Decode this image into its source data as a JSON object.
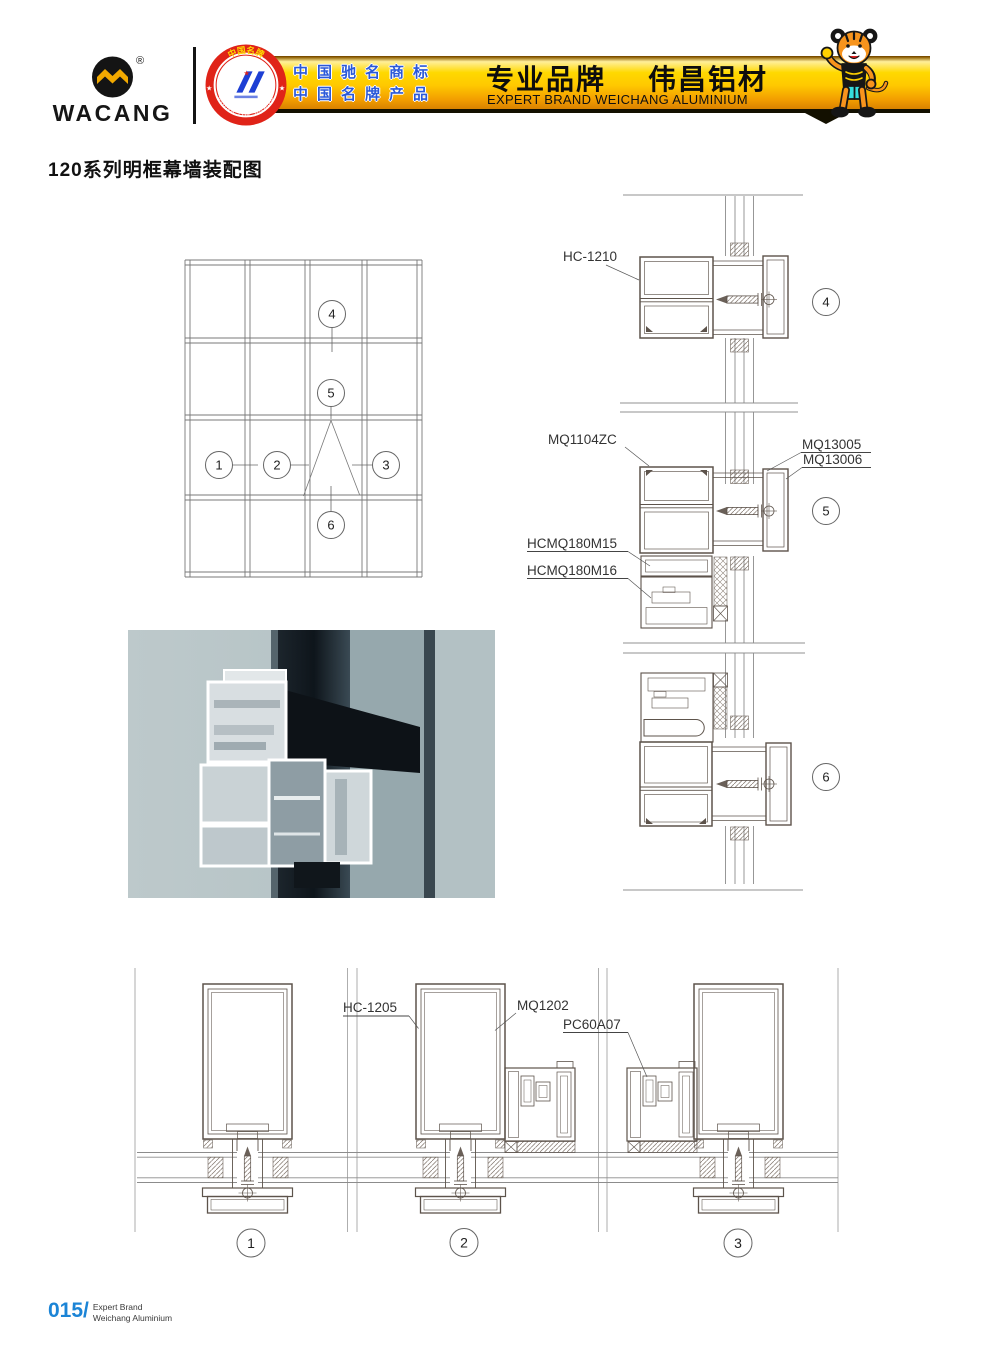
{
  "header": {
    "logo": {
      "brand": "WACANG",
      "registered": "®"
    },
    "badge": {
      "top_text": "中国名牌",
      "bottom_text": "CHINA TOP BRAND"
    },
    "banner": {
      "claim_line1": "中国驰名商标",
      "claim_line2": "中国名牌产品",
      "slogan_cn": "专业品牌",
      "brand_cn": "伟昌铝材",
      "slogan_en": "EXPERT BRAND WEICHANG ALUMINIUM"
    },
    "mascot_icon": "tiger-mascot"
  },
  "page": {
    "title": "120系列明框幕墙装配图"
  },
  "drawings": {
    "labels": {
      "hc1210": "HC-1210",
      "mq1104zc": "MQ1104ZC",
      "mq13005": "MQ13005",
      "mq13006": "MQ13006",
      "hcmq180m15": "HCMQ180M15",
      "hcmq180m16": "HCMQ180M16",
      "hc1205": "HC-1205",
      "mq1202": "MQ1202",
      "pc60a07": "PC60A07"
    },
    "callouts": {
      "c1": "1",
      "c2": "2",
      "c3": "3",
      "c4": "4",
      "c5": "5",
      "c6": "6"
    }
  },
  "footer": {
    "page_number": "015/",
    "line1": "Expert Brand",
    "line2": "Weichang Aluminium"
  },
  "colors": {
    "accent_blue": "#1b84d6",
    "bar_yellow": "#ffd900",
    "bar_orange": "#f29d00",
    "claim_blue": "#2b59d8",
    "badge_red": "#e02318",
    "line_ink": "#5d534b"
  }
}
